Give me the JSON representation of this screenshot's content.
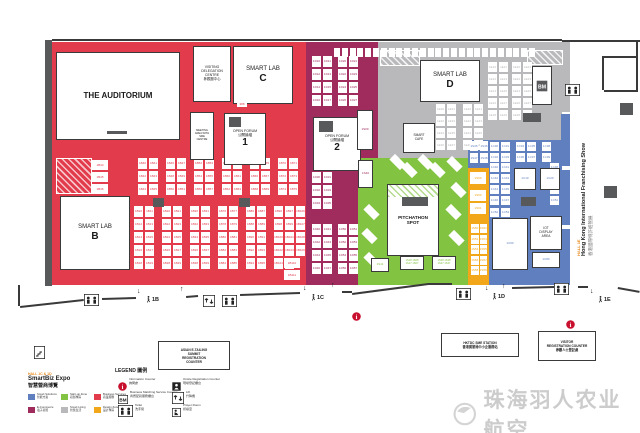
{
  "colors": {
    "red": "#E23B4B",
    "purple": "#A02C5E",
    "gray": "#B9B9BC",
    "green": "#82C341",
    "yellow": "#F2A71B",
    "blue": "#5F7FBE",
    "dark": "#58595B",
    "wall": "#3A3A3A",
    "info": "#C8102E",
    "watermark": "#CCCCCC"
  },
  "zones": [
    {
      "name": "business-services-red",
      "c": "red",
      "x": 52,
      "y": 42,
      "w": 254,
      "h": 243
    },
    {
      "name": "ecommerce-purple",
      "c": "purple",
      "x": 306,
      "y": 42,
      "w": 72,
      "h": 243
    },
    {
      "name": "smart-living-gray",
      "c": "gray",
      "x": 378,
      "y": 42,
      "w": 184,
      "h": 98
    },
    {
      "name": "smart-living-gray-lower",
      "c": "gray",
      "x": 378,
      "y": 140,
      "w": 90,
      "h": 18
    },
    {
      "name": "smart-tech-blue",
      "c": "blue",
      "x": 468,
      "y": 140,
      "w": 94,
      "h": 145
    },
    {
      "name": "startup-green",
      "c": "green",
      "x": 358,
      "y": 158,
      "w": 110,
      "h": 127
    },
    {
      "name": "design-yellow",
      "c": "yellow",
      "x": 468,
      "y": 168,
      "w": 21,
      "h": 117
    }
  ],
  "hatches": [
    {
      "kind": "red",
      "x": 56,
      "y": 158,
      "w": 34,
      "h": 34
    },
    {
      "kind": "gray",
      "x": 380,
      "y": 50,
      "w": 38,
      "h": 14
    },
    {
      "kind": "gray",
      "x": 527,
      "y": 50,
      "w": 34,
      "h": 13
    }
  ],
  "rightStrip": {
    "x": 561,
    "w": 9,
    "segs": [
      {
        "y": 42,
        "h": 70,
        "c": "gray"
      },
      {
        "y": 114,
        "h": 52,
        "c": "blue"
      },
      {
        "y": 170,
        "h": 55,
        "c": "blue"
      },
      {
        "y": 229,
        "h": 56,
        "c": "blue"
      }
    ]
  },
  "rooms": [
    {
      "id": "auditorium",
      "x": 56,
      "y": 52,
      "w": 122,
      "h": 86,
      "lines": [
        "THE AUDITORIUM"
      ],
      "fs": 8,
      "bold": true,
      "stage": {
        "x": 50,
        "y": 78,
        "w": 20,
        "h": 2.5
      }
    },
    {
      "id": "visiting-delegation-centre",
      "x": 193,
      "y": 46,
      "w": 36,
      "h": 54,
      "lines": [
        "VISITING",
        "DELEGATION",
        "CENTRE",
        "參觀團中心"
      ],
      "fs": 3.4
    },
    {
      "id": "smart-lab-c",
      "x": 233,
      "y": 46,
      "w": 58,
      "h": 56,
      "lines": [
        "SMART LAB"
      ],
      "big": "C",
      "fs": 6
    },
    {
      "id": "meeting-area",
      "x": 190,
      "y": 112,
      "w": 22,
      "h": 46,
      "lines": [
        "MEETING",
        "AREA WITH",
        "SME",
        "CENTRE"
      ],
      "fs": 2.6
    },
    {
      "id": "open-forum-1",
      "x": 224,
      "y": 113,
      "w": 40,
      "h": 50,
      "lines": [
        "OPEN FORUM",
        "公開論壇"
      ],
      "big": "1",
      "fs": 3.6,
      "stage": {
        "x": 4,
        "y": 3,
        "w": 12,
        "h": 10
      }
    },
    {
      "id": "smart-lab-b",
      "x": 60,
      "y": 196,
      "w": 68,
      "h": 72,
      "lines": [
        "SMART LAB"
      ],
      "big": "B",
      "fs": 6
    },
    {
      "id": "open-forum-2",
      "x": 313,
      "y": 117,
      "w": 46,
      "h": 52,
      "lines": [
        "OPEN FORUM",
        "公開論壇"
      ],
      "big": "2",
      "fs": 3.6,
      "stage": {
        "x": 5,
        "y": 3,
        "w": 14,
        "h": 11
      }
    },
    {
      "id": "smart-lab-d",
      "x": 420,
      "y": 60,
      "w": 58,
      "h": 40,
      "lines": [
        "SMART LAB"
      ],
      "big": "D",
      "fs": 6
    },
    {
      "id": "smart-cafe",
      "x": 403,
      "y": 123,
      "w": 30,
      "h": 28,
      "lines": [
        "SMART",
        "CAFE"
      ],
      "fs": 3.2
    },
    {
      "id": "pitchathon-spot",
      "x": 387,
      "y": 184,
      "w": 50,
      "h": 70,
      "lines": [
        "PITCHATHON",
        "SPOT"
      ],
      "fs": 4.6,
      "bold": true,
      "hatchTop": 12,
      "stage": {
        "x": 14,
        "y": 12,
        "w": 26,
        "h": 9
      }
    },
    {
      "id": "bm-booth",
      "x": 532,
      "y": 66,
      "w": 18,
      "h": 37,
      "bmicon": true
    },
    {
      "id": "blue-booth-1",
      "x": 514,
      "y": 168,
      "w": 20,
      "h": 20,
      "lines": [
        "1C10"
      ],
      "fs": 3,
      "tc": "blue"
    },
    {
      "id": "blue-booth-2",
      "x": 540,
      "y": 168,
      "w": 18,
      "h": 20,
      "lines": [
        "1C20"
      ],
      "fs": 3,
      "tc": "blue"
    },
    {
      "id": "blue-booth-big",
      "x": 492,
      "y": 218,
      "w": 34,
      "h": 50,
      "lines": [
        "1C60"
      ],
      "fs": 3,
      "tc": "blue"
    },
    {
      "id": "iot-display-area",
      "x": 530,
      "y": 216,
      "w": 30,
      "h": 32,
      "lines": [
        "IOT",
        "DISPLAY",
        "AREA"
      ],
      "fs": 3.2
    },
    {
      "id": "blue-booth-3",
      "x": 532,
      "y": 252,
      "w": 26,
      "h": 14,
      "lines": [
        "1C80"
      ],
      "fs": 3,
      "tc": "blue"
    },
    {
      "id": "purple-booth-1s09",
      "x": 357,
      "y": 110,
      "w": 14,
      "h": 38,
      "lines": [
        "1S09"
      ],
      "fs": 3,
      "tc": "purple"
    },
    {
      "id": "purple-booth-1s40",
      "x": 358,
      "y": 160,
      "w": 13,
      "h": 26,
      "lines": [
        "1S40"
      ],
      "fs": 3,
      "tc": "purple"
    },
    {
      "id": "green-booth-1",
      "x": 371,
      "y": 258,
      "w": 16,
      "h": 12,
      "lines": [
        "1S11"
      ],
      "fs": 3,
      "tc": "green"
    },
    {
      "id": "green-booth-2",
      "x": 400,
      "y": 256,
      "w": 22,
      "h": 12,
      "lines": [
        "1S18 1S08",
        "1S17 1S07"
      ],
      "fs": 2.6,
      "tc": "green"
    },
    {
      "id": "green-booth-3",
      "x": 432,
      "y": 256,
      "w": 22,
      "h": 12,
      "lines": [
        "1S28 1S38",
        "1S27 1S37"
      ],
      "fs": 2.6,
      "tc": "green"
    }
  ],
  "grids": [
    {
      "x": 92,
      "y": 160,
      "cols": 1,
      "rows": 3,
      "cw": 16,
      "ch": 10,
      "gx": 0,
      "gy": 2,
      "p": "1B",
      "s": 44,
      "c": "red"
    },
    {
      "x": 138,
      "y": 158,
      "cols": 2,
      "rows": 3,
      "cw": 9,
      "ch": 11,
      "gx": 2,
      "gy": 2,
      "p": "1B",
      "s": 40,
      "c": "red"
    },
    {
      "x": 166,
      "y": 158,
      "cols": 2,
      "rows": 3,
      "cw": 9,
      "ch": 11,
      "gx": 2,
      "gy": 2,
      "p": "1B",
      "s": 46,
      "c": "red"
    },
    {
      "x": 194,
      "y": 158,
      "cols": 2,
      "rows": 3,
      "cw": 9,
      "ch": 11,
      "gx": 2,
      "gy": 2,
      "p": "1B",
      "s": 52,
      "c": "red"
    },
    {
      "x": 222,
      "y": 158,
      "cols": 2,
      "rows": 3,
      "cw": 9,
      "ch": 11,
      "gx": 2,
      "gy": 2,
      "p": "1B",
      "s": 58,
      "c": "red"
    },
    {
      "x": 250,
      "y": 158,
      "cols": 2,
      "rows": 3,
      "cw": 9,
      "ch": 11,
      "gx": 2,
      "gy": 2,
      "p": "1B",
      "s": 64,
      "c": "red"
    },
    {
      "x": 278,
      "y": 158,
      "cols": 2,
      "rows": 3,
      "cw": 9,
      "ch": 11,
      "gx": 2,
      "gy": 2,
      "p": "1B",
      "s": 70,
      "c": "red"
    },
    {
      "x": 134,
      "y": 206,
      "cols": 2,
      "rows": 5,
      "cw": 9,
      "ch": 11,
      "gx": 2,
      "gy": 2,
      "p": "1B",
      "s": 10,
      "c": "red"
    },
    {
      "x": 162,
      "y": 206,
      "cols": 2,
      "rows": 5,
      "cw": 9,
      "ch": 11,
      "gx": 2,
      "gy": 2,
      "p": "1B",
      "s": 20,
      "c": "red"
    },
    {
      "x": 190,
      "y": 206,
      "cols": 2,
      "rows": 5,
      "cw": 9,
      "ch": 11,
      "gx": 2,
      "gy": 2,
      "p": "1B",
      "s": 30,
      "c": "red"
    },
    {
      "x": 218,
      "y": 206,
      "cols": 2,
      "rows": 5,
      "cw": 9,
      "ch": 11,
      "gx": 2,
      "gy": 2,
      "p": "1B",
      "s": 76,
      "c": "red"
    },
    {
      "x": 246,
      "y": 206,
      "cols": 2,
      "rows": 5,
      "cw": 9,
      "ch": 11,
      "gx": 2,
      "gy": 2,
      "p": "1B",
      "s": 86,
      "c": "red"
    },
    {
      "x": 274,
      "y": 206,
      "cols": 2,
      "rows": 5,
      "cw": 9,
      "ch": 11,
      "gx": 2,
      "gy": 2,
      "p": "1B",
      "s": 96,
      "c": "red"
    },
    {
      "x": 296,
      "y": 206,
      "cols": 1,
      "rows": 4,
      "cw": 9,
      "ch": 11,
      "gx": 0,
      "gy": 2,
      "p": "1B",
      "s": 106,
      "c": "red"
    },
    {
      "x": 284,
      "y": 258,
      "cols": 1,
      "rows": 2,
      "cw": 16,
      "ch": 10,
      "gx": 0,
      "gy": 2,
      "p": "1B",
      "s": 110,
      "c": "red"
    },
    {
      "x": 312,
      "y": 56,
      "cols": 2,
      "rows": 4,
      "cw": 9,
      "ch": 11,
      "gx": 2,
      "gy": 2,
      "p": "1D",
      "s": 10,
      "c": "purple"
    },
    {
      "x": 338,
      "y": 56,
      "cols": 2,
      "rows": 4,
      "cw": 9,
      "ch": 11,
      "gx": 2,
      "gy": 2,
      "p": "1D",
      "s": 20,
      "c": "purple"
    },
    {
      "x": 312,
      "y": 172,
      "cols": 2,
      "rows": 3,
      "cw": 9,
      "ch": 11,
      "gx": 2,
      "gy": 2,
      "p": "1D",
      "s": 30,
      "c": "purple"
    },
    {
      "x": 312,
      "y": 224,
      "cols": 2,
      "rows": 4,
      "cw": 9,
      "ch": 11,
      "gx": 2,
      "gy": 2,
      "p": "1D",
      "s": 40,
      "c": "purple"
    },
    {
      "x": 338,
      "y": 224,
      "cols": 2,
      "rows": 4,
      "cw": 9,
      "ch": 11,
      "gx": 2,
      "gy": 2,
      "p": "1D",
      "s": 50,
      "c": "purple"
    },
    {
      "x": 488,
      "y": 62,
      "cols": 2,
      "rows": 5,
      "cw": 9,
      "ch": 10,
      "gx": 2,
      "gy": 2,
      "p": "1E",
      "s": 10,
      "c": "gray"
    },
    {
      "x": 512,
      "y": 62,
      "cols": 2,
      "rows": 5,
      "cw": 9,
      "ch": 10,
      "gx": 2,
      "gy": 2,
      "p": "1E",
      "s": 20,
      "c": "gray"
    },
    {
      "x": 436,
      "y": 104,
      "cols": 2,
      "rows": 4,
      "cw": 9,
      "ch": 10,
      "gx": 2,
      "gy": 2,
      "p": "1E",
      "s": 30,
      "c": "gray"
    },
    {
      "x": 463,
      "y": 104,
      "cols": 2,
      "rows": 4,
      "cw": 9,
      "ch": 10,
      "gx": 2,
      "gy": 2,
      "p": "1E",
      "s": 40,
      "c": "gray"
    },
    {
      "x": 490,
      "y": 142,
      "cols": 2,
      "rows": 2,
      "cw": 9,
      "ch": 9,
      "gx": 2,
      "gy": 2,
      "p": "1C",
      "s": 30,
      "c": "blue"
    },
    {
      "x": 516,
      "y": 142,
      "cols": 2,
      "rows": 2,
      "cw": 9,
      "ch": 9,
      "gx": 2,
      "gy": 2,
      "p": "1C",
      "s": 34,
      "c": "blue"
    },
    {
      "x": 542,
      "y": 142,
      "cols": 1,
      "rows": 2,
      "cw": 9,
      "ch": 9,
      "gx": 0,
      "gy": 2,
      "p": "1C",
      "s": 38,
      "c": "blue"
    },
    {
      "x": 490,
      "y": 163,
      "cols": 2,
      "rows": 4,
      "cw": 9,
      "ch": 9,
      "gx": 2,
      "gy": 2,
      "p": "1C",
      "s": 40,
      "c": "blue"
    },
    {
      "x": 550,
      "y": 163,
      "cols": 1,
      "rows": 4,
      "cw": 9,
      "ch": 9,
      "gx": 0,
      "gy": 2,
      "p": "1C",
      "s": 48,
      "c": "blue"
    },
    {
      "x": 490,
      "y": 208,
      "cols": 2,
      "rows": 1,
      "cw": 9,
      "ch": 9,
      "gx": 2,
      "gy": 2,
      "p": "1C",
      "s": 52,
      "c": "blue"
    },
    {
      "x": 470,
      "y": 141,
      "cols": 2,
      "rows": 2,
      "cw": 8,
      "ch": 10,
      "gx": 2,
      "gy": 2,
      "p": "1S",
      "s": 45,
      "c": "blue"
    },
    {
      "x": 470,
      "y": 172,
      "cols": 1,
      "rows": 1,
      "cw": 16,
      "ch": 12,
      "gx": 0,
      "gy": 2,
      "p": "1S",
      "s": 69,
      "c": "yellow"
    },
    {
      "x": 470,
      "y": 190,
      "cols": 1,
      "rows": 2,
      "cw": 16,
      "ch": 11,
      "gx": 0,
      "gy": 2,
      "p": "1S",
      "s": 60,
      "c": "yellow"
    },
    {
      "x": 471,
      "y": 224,
      "cols": 2,
      "rows": 5,
      "cw": 7.5,
      "ch": 9,
      "gx": 1,
      "gy": 1.5,
      "p": "1S",
      "s": 50,
      "c": "yellow"
    },
    {
      "x": 334,
      "y": 48,
      "cols": 26,
      "rows": 1,
      "cw": 6,
      "ch": 9,
      "gx": 1.8,
      "gy": 0,
      "p": "",
      "s": 1,
      "c": "purple"
    }
  ],
  "diagonals": [
    {
      "x": 390,
      "y": 158
    },
    {
      "x": 402,
      "y": 166
    },
    {
      "x": 418,
      "y": 158
    },
    {
      "x": 430,
      "y": 166
    },
    {
      "x": 447,
      "y": 160
    },
    {
      "x": 451,
      "y": 186
    },
    {
      "x": 446,
      "y": 208
    },
    {
      "x": 449,
      "y": 234
    },
    {
      "x": 364,
      "y": 208
    },
    {
      "x": 362,
      "y": 232
    },
    {
      "x": 364,
      "y": 256
    }
  ],
  "pillars": [
    {
      "x": 153,
      "y": 198,
      "w": 11,
      "h": 9
    },
    {
      "x": 239,
      "y": 198,
      "w": 11,
      "h": 9
    },
    {
      "x": 523,
      "y": 113,
      "w": 18,
      "h": 9
    },
    {
      "x": 521,
      "y": 197,
      "w": 15,
      "h": 9
    },
    {
      "x": 620,
      "y": 103,
      "w": 13,
      "h": 12
    },
    {
      "x": 604,
      "y": 186,
      "w": 13,
      "h": 12
    }
  ],
  "walls": [
    [
      52,
      39,
      562,
      39
    ],
    [
      562,
      40,
      640,
      40
    ],
    [
      20,
      285,
      20,
      306
    ],
    [
      20,
      306,
      84,
      299
    ],
    [
      102,
      298,
      136,
      297
    ],
    [
      186,
      296,
      198,
      295
    ],
    [
      240,
      294,
      300,
      292
    ],
    [
      342,
      291,
      352,
      291
    ],
    [
      352,
      293,
      428,
      283
    ],
    [
      428,
      283,
      452,
      283
    ],
    [
      512,
      287,
      554,
      286
    ],
    [
      578,
      286,
      588,
      286
    ],
    [
      618,
      287,
      640,
      291
    ],
    [
      604,
      56,
      638,
      56
    ],
    [
      638,
      56,
      638,
      90
    ],
    [
      604,
      90,
      638,
      90
    ],
    [
      604,
      56,
      604,
      90
    ],
    [
      638,
      40,
      638,
      56
    ]
  ],
  "leftWall": {
    "x": 45,
    "y": 40,
    "w": 7,
    "h": 246
  },
  "iconBoxes": [
    {
      "t": "toilet",
      "x": 84,
      "y": 293
    },
    {
      "t": "lift",
      "x": 203,
      "y": 294
    },
    {
      "t": "toilet",
      "x": 222,
      "y": 294
    },
    {
      "t": "toilet",
      "x": 456,
      "y": 287
    },
    {
      "t": "toilet",
      "x": 554,
      "y": 282
    },
    {
      "t": "toilet",
      "x": 565,
      "y": 83
    },
    {
      "t": "stairs",
      "x": 34,
      "y": 346
    }
  ],
  "infoDots": [
    {
      "x": 352,
      "y": 308
    },
    {
      "x": 566,
      "y": 316
    }
  ],
  "entrances": [
    {
      "label": "1B",
      "x": 146,
      "y": 296,
      "down": [
        137,
        288
      ],
      "up": [
        180,
        286
      ]
    },
    {
      "label": "1C",
      "x": 311,
      "y": 294,
      "down": [
        303,
        285
      ],
      "up": [
        331,
        282
      ]
    },
    {
      "label": "1D",
      "x": 492,
      "y": 293,
      "down": [
        485,
        285
      ],
      "up": [
        502,
        283
      ]
    },
    {
      "label": "1E",
      "x": 598,
      "y": 296,
      "down": [
        590,
        288
      ],
      "up": null
    }
  ],
  "counters": [
    {
      "id": "asian-etailing",
      "x": 158,
      "y": 341,
      "w": 70,
      "h": 27,
      "lines": [
        "ASIAN E-TAILING",
        "SUMMIT",
        "REGISTRATION",
        "COUNTER"
      ]
    },
    {
      "id": "sme-station",
      "x": 441,
      "y": 333,
      "w": 76,
      "h": 22,
      "lines": [
        "HKTDC SME STATION",
        "香港貿發局中小企服務站"
      ]
    },
    {
      "id": "visitor-registration",
      "x": 538,
      "y": 331,
      "w": 56,
      "h": 28,
      "lines": [
        "VISITOR",
        "REGISTRATION COUNTER",
        "參觀人士登記處"
      ]
    }
  ],
  "minorLabels": [
    {
      "text": "388",
      "x": 237,
      "y": 102,
      "w": 10,
      "h": 5,
      "c": "red"
    }
  ],
  "corridor": {
    "orange": "HALL 1E",
    "title": "Hong Kong International Franchising Show",
    "zh": "香港國際特許經營展"
  },
  "legend_plan": {
    "orange": "HALL 1C & 1D",
    "title": "SmartBiz Expo",
    "zh": "智慧營商博覽",
    "zones": [
      {
        "en": "Smart Solutions",
        "zh": "智能方案",
        "c": "blue"
      },
      {
        "en": "Start-up Zone",
        "zh": "初創專區",
        "c": "green"
      },
      {
        "en": "Business Services",
        "zh": "商業服務",
        "c": "red"
      },
      {
        "en": "E-Commerce",
        "zh": "電子商貿",
        "c": "purple"
      },
      {
        "en": "Smart Living",
        "zh": "智慧生活",
        "c": "gray"
      },
      {
        "en": "Design Zone",
        "zh": "設計專區",
        "c": "yellow"
      }
    ]
  },
  "legend_icons": {
    "title": "LEGEND 圖例",
    "items": [
      {
        "icon": "info",
        "en": "Information Counter",
        "zh": "詢問處"
      },
      {
        "icon": "bm",
        "en": "Business Matching Service Counter",
        "zh": "商貿配對服務櫃台"
      },
      {
        "icon": "toilet",
        "en": "Toilet",
        "zh": "洗手間"
      },
      {
        "icon": "reg",
        "en": "Onsite Registration Counter",
        "zh": "現場登記櫃台"
      },
      {
        "icon": "lift",
        "en": "Lift",
        "zh": "升降機"
      },
      {
        "icon": "prayer",
        "en": "Prayer Room",
        "zh": "祈禱室"
      }
    ]
  },
  "watermark": {
    "text": "珠海羽人农业航空"
  }
}
